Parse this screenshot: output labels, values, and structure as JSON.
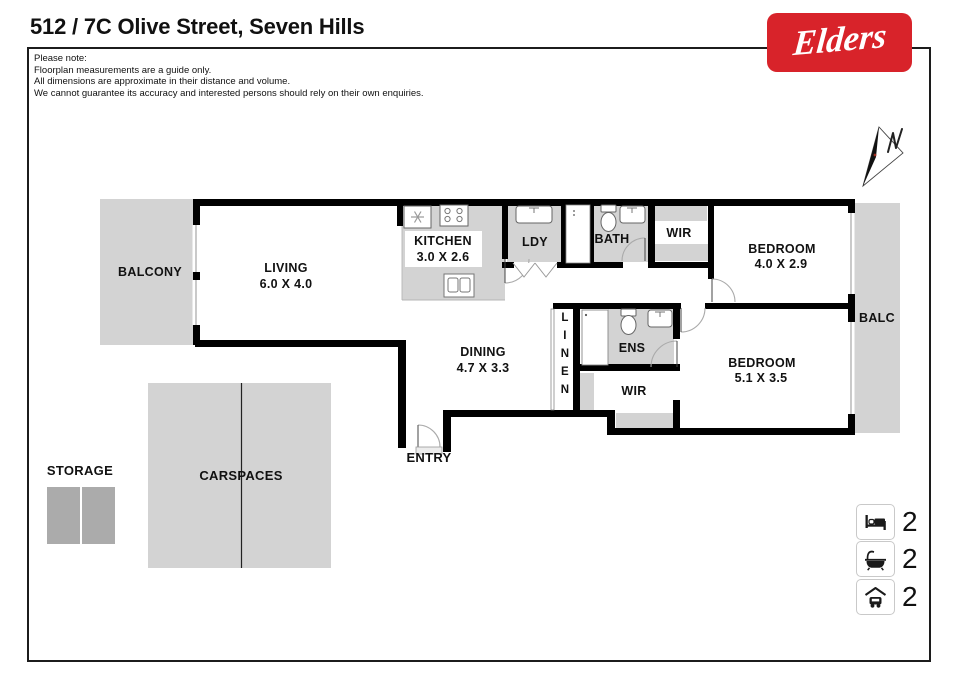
{
  "title": "512 / 7C Olive Street, Seven Hills",
  "brand": {
    "logo_text": "Elders",
    "logo_color": "#D8232A"
  },
  "disclaimer": {
    "lines": [
      "Please note:",
      "Floorplan measurements are a guide only.",
      "All dimensions are approximate in their distance and volume.",
      "We cannot guarantee its accuracy and interested persons should rely on their own enquiries."
    ]
  },
  "compass": {
    "label": "N"
  },
  "rooms": {
    "balcony_left": {
      "name": "BALCONY"
    },
    "living": {
      "name": "LIVING",
      "dims": "6.0 X 4.0"
    },
    "kitchen": {
      "name": "KITCHEN",
      "dims": "3.0 X 2.6"
    },
    "laundry": {
      "name": "LDY"
    },
    "bath": {
      "name": "BATH"
    },
    "wir1": {
      "name": "WIR"
    },
    "bedroom1": {
      "name": "BEDROOM",
      "dims": "4.0 X 2.9"
    },
    "balcony_right": {
      "name": "BALC"
    },
    "dining": {
      "name": "DINING",
      "dims": "4.7 X 3.3"
    },
    "linen": {
      "name": "LINEN",
      "letters": [
        "L",
        "I",
        "N",
        "E",
        "N"
      ]
    },
    "ensuite": {
      "name": "ENS"
    },
    "wir2": {
      "name": "WIR"
    },
    "bedroom2": {
      "name": "BEDROOM",
      "dims": "5.1 X 3.5"
    },
    "entry": {
      "name": "ENTRY"
    },
    "storage": {
      "name": "STORAGE"
    },
    "carspaces": {
      "name": "CARSPACES"
    }
  },
  "legend": {
    "items": [
      {
        "name": "bedrooms",
        "icon": "bed-icon",
        "count": "2"
      },
      {
        "name": "bathrooms",
        "icon": "bath-icon",
        "count": "2"
      },
      {
        "name": "carspaces",
        "icon": "car-icon",
        "count": "2"
      }
    ]
  },
  "colors": {
    "wall": "#000000",
    "floor_gray": "#D3D3D3",
    "storage_gray": "#ABABAB",
    "logo_red": "#D8232A"
  }
}
